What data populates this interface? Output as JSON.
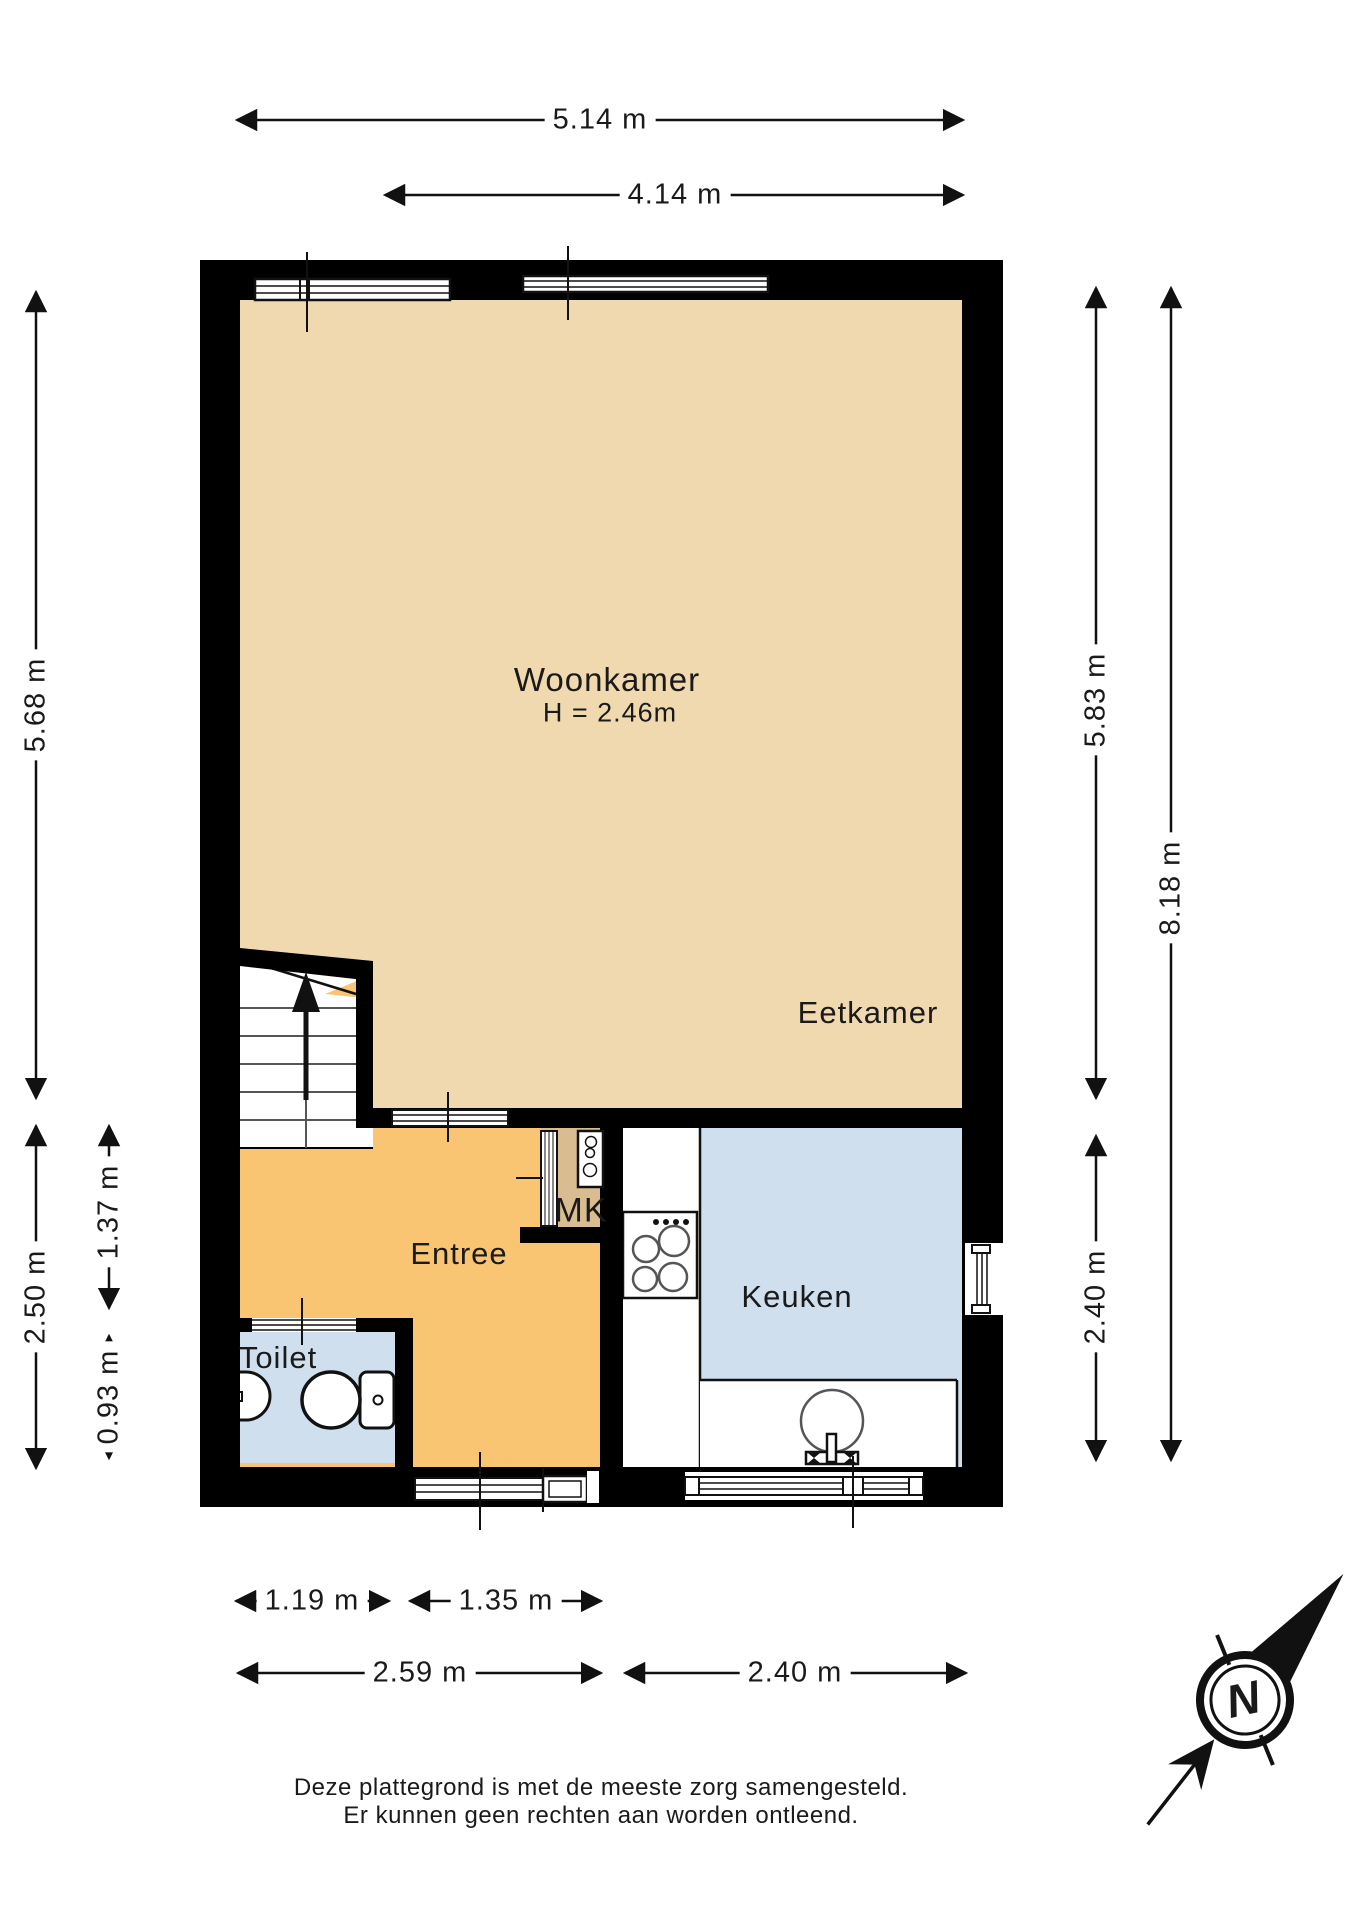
{
  "floor_plan": {
    "rooms": {
      "woonkamer": {
        "label": "Woonkamer",
        "height_note": "H = 2.46m"
      },
      "eetkamer": {
        "label": "Eetkamer"
      },
      "entree": {
        "label": "Entree"
      },
      "mk": {
        "label": "MK"
      },
      "keuken": {
        "label": "Keuken"
      },
      "toilet": {
        "label": "Toilet"
      }
    },
    "dimensions": {
      "top": [
        {
          "label": "5.14 m"
        },
        {
          "label": "4.14 m"
        }
      ],
      "left": [
        {
          "label": "5.68 m"
        },
        {
          "label": "2.50 m"
        },
        {
          "label": "1.37 m"
        },
        {
          "label": "0.93 m"
        }
      ],
      "right": [
        {
          "label": "5.83 m"
        },
        {
          "label": "8.18 m"
        },
        {
          "label": "2.40 m"
        }
      ],
      "bottom": [
        {
          "label": "1.19 m"
        },
        {
          "label": "1.35 m"
        },
        {
          "label": "2.59 m"
        },
        {
          "label": "2.40 m"
        }
      ]
    },
    "compass": {
      "north_label": "N"
    },
    "disclaimer": {
      "line1": "Deze plattegrond is met de meeste zorg samengesteld.",
      "line2": "Er kunnen geen rechten aan worden ontleend."
    },
    "colors": {
      "wall": "#000000",
      "living": "#f0d9ae",
      "entry": "#fac573",
      "kitchen": "#cfdfee",
      "toilet": "#cfdfee",
      "meter_closet": "#d9bd90",
      "fixture": "#ffffff"
    }
  }
}
